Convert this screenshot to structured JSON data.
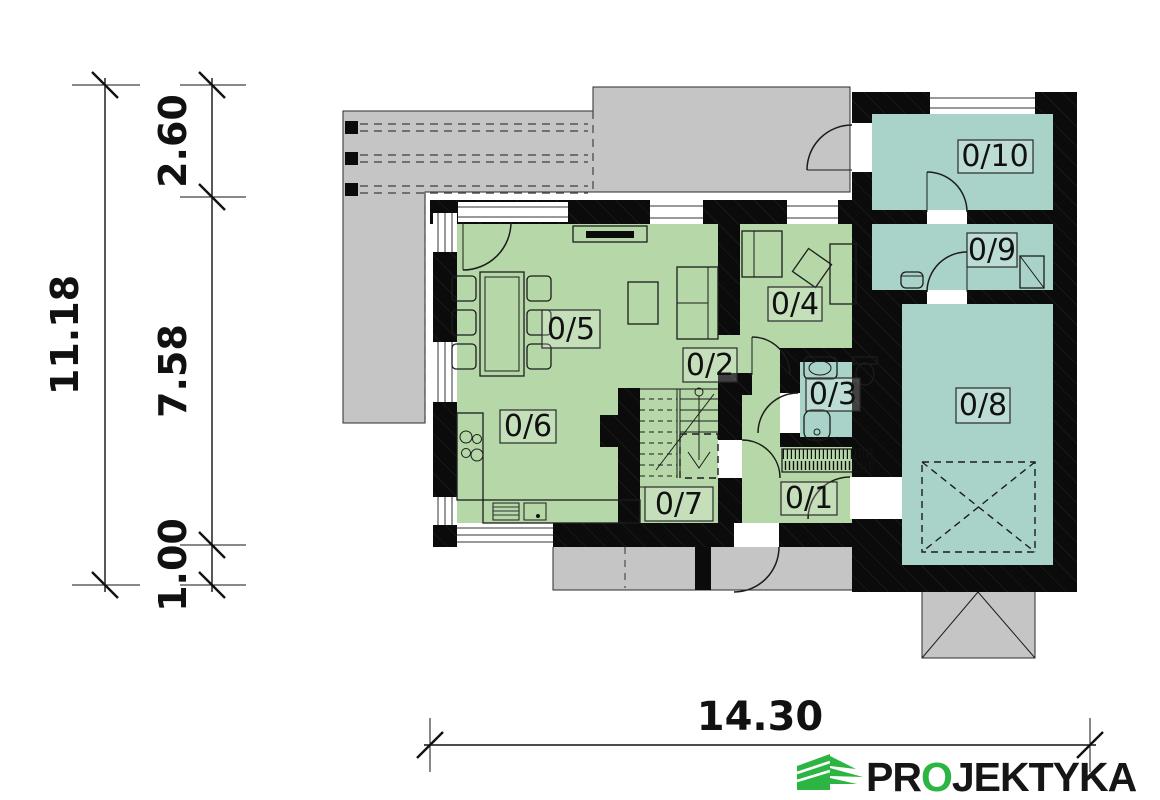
{
  "dimensions": {
    "total_height": "11.18",
    "segment_top": "2.60",
    "segment_middle": "7.58",
    "segment_bottom": "1.00",
    "total_width": "14.30"
  },
  "rooms": [
    {
      "label": "0/1"
    },
    {
      "label": "0/2"
    },
    {
      "label": "0/3"
    },
    {
      "label": "0/4"
    },
    {
      "label": "0/5"
    },
    {
      "label": "0/6"
    },
    {
      "label": "0/7"
    },
    {
      "label": "0/8"
    },
    {
      "label": "0/9"
    },
    {
      "label": "0/10"
    }
  ],
  "logo": {
    "prefix": "PR",
    "accent": "O",
    "suffix": "JEKTYKA"
  },
  "colors": {
    "room_green": "#b6d7a8",
    "room_teal": "#a9d3c9",
    "paving": "#c5c5c5",
    "wall": "#0b0b0b",
    "logo_green": "#2db544",
    "ink": "#161616"
  }
}
